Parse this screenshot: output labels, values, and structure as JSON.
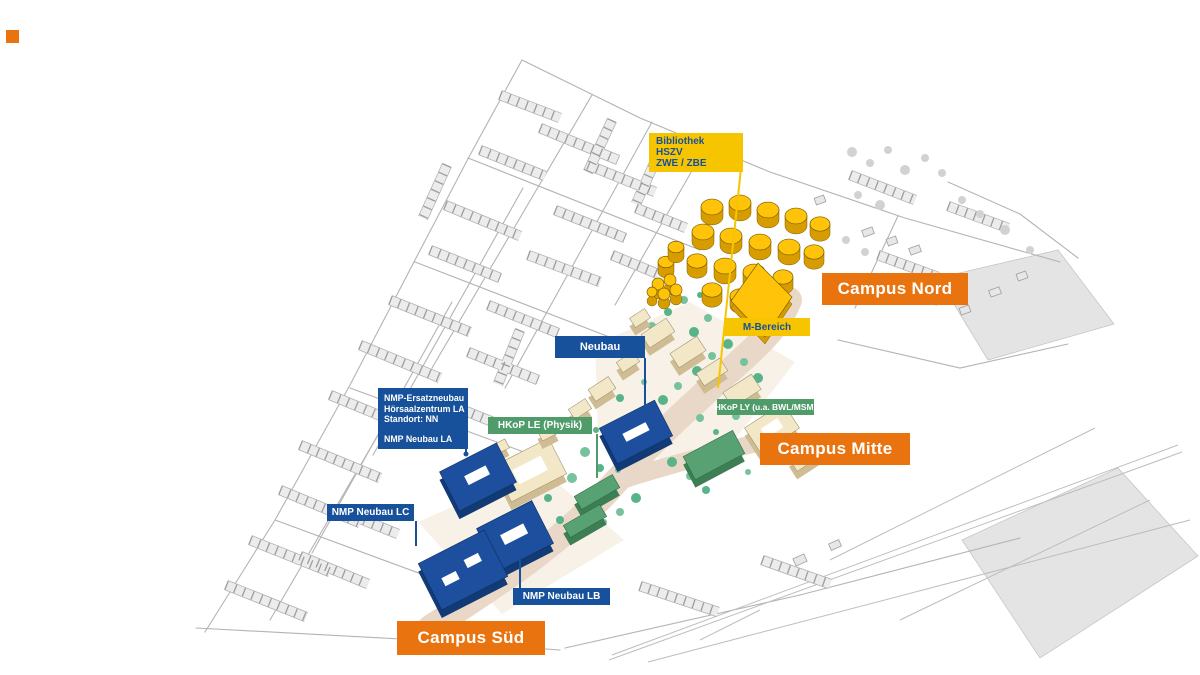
{
  "labels": {
    "bibliothek": {
      "lines": [
        "Bibliothek",
        "HSZV",
        "ZWE / ZBE"
      ]
    },
    "m_bereich": {
      "text": "M-Bereich"
    },
    "neubau": {
      "text": "Neubau"
    },
    "nmp_la": {
      "lines": [
        "NMP-Ersatzneubau",
        "Hörsaalzentrum LA",
        "Standort: NN"
      ],
      "text2": "NMP Neubau LA"
    },
    "hkop_le": {
      "text": "HKoP LE (Physik)"
    },
    "hkop_ly": {
      "text": "HKoP LY (u.a. BWL/MSM)"
    },
    "nmp_lc": {
      "text": "NMP Neubau LC"
    },
    "nmp_lb": {
      "text": "NMP Neubau LB"
    },
    "campus_nord": {
      "text": "Campus Nord"
    },
    "campus_mitte": {
      "text": "Campus Mitte"
    },
    "campus_sued": {
      "text": "Campus Süd"
    }
  },
  "colors": {
    "campus_orange": "#E8730F",
    "label_blue": "#17509B",
    "label_yellow": "#F7C500",
    "label_green": "#4F9C6A",
    "building_blue": "#1D4F9E",
    "building_yellow": "#FFC30A",
    "building_beige": "#F2E7C7",
    "building_green": "#58A173",
    "tree_green": "#76C29D"
  }
}
